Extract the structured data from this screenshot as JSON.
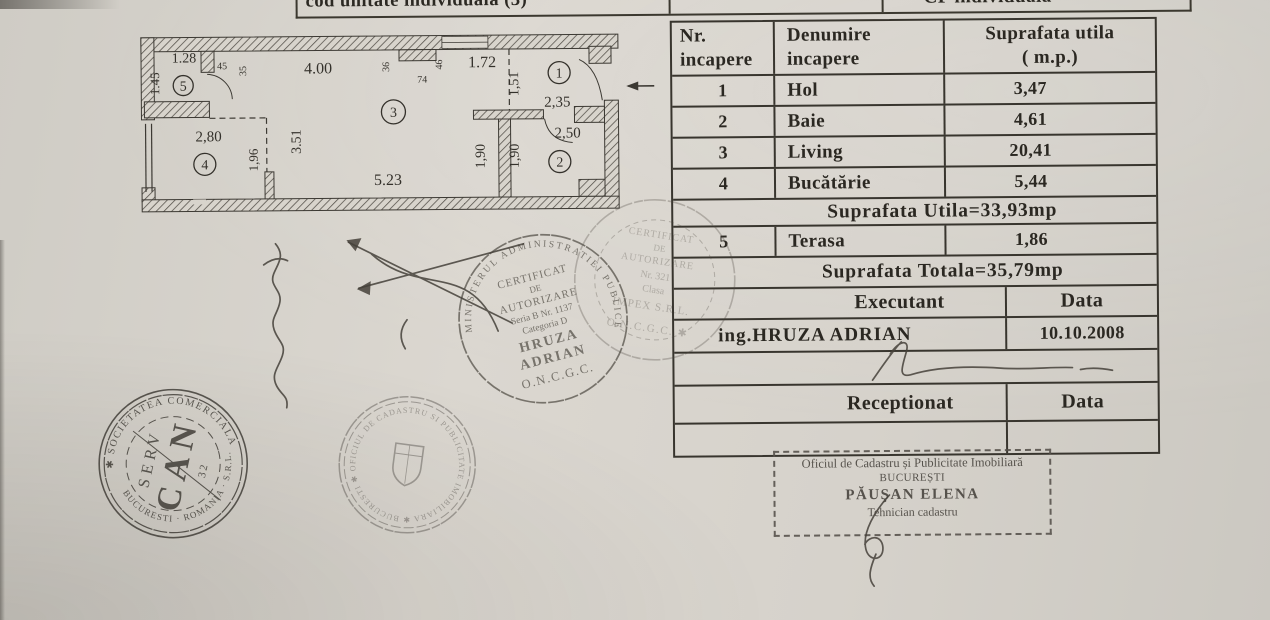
{
  "header_strip": {
    "cell1": "cod unitate individuala (3)",
    "cell2": "",
    "cell3": "CF individuala"
  },
  "room_table": {
    "header": {
      "c1a": "Nr.",
      "c1b": "incapere",
      "c2a": "Denumire",
      "c2b": "incapere",
      "c3a": "Suprafata utila",
      "c3b": "( m.p.)"
    },
    "rows": [
      {
        "nr": "1",
        "name": "Hol",
        "area": "3,47"
      },
      {
        "nr": "2",
        "name": "Baie",
        "area": "4,61"
      },
      {
        "nr": "3",
        "name": "Living",
        "area": "20,41"
      },
      {
        "nr": "4",
        "name": "Bucătărie",
        "area": "5,44"
      }
    ],
    "subtotal": "Suprafata Utila=33,93mp",
    "row5": {
      "nr": "5",
      "name": "Terasa",
      "area": "1,86"
    },
    "total": "Suprafata Totala=35,79mp",
    "executant": {
      "label": "Executant",
      "date_label": "Data",
      "name": "ing.HRUZA ADRIAN",
      "date": "10.10.2008"
    },
    "receptionat": {
      "label": "Receptionat",
      "date_label": "Data"
    }
  },
  "plan": {
    "dims": [
      {
        "text": "1.28",
        "x": 58,
        "y": 33,
        "fs": 14
      },
      {
        "text": "1.45",
        "x": 33,
        "y": 54,
        "rot": -90,
        "fs": 13
      },
      {
        "text": "45",
        "x": 96,
        "y": 40,
        "fs": 10
      },
      {
        "text": "35",
        "x": 120,
        "y": 42,
        "rot": -90,
        "fs": 10
      },
      {
        "text": "4.00",
        "x": 192,
        "y": 45,
        "fs": 16
      },
      {
        "text": "36",
        "x": 263,
        "y": 39,
        "rot": -90,
        "fs": 10
      },
      {
        "text": "74",
        "x": 296,
        "y": 55,
        "fs": 10
      },
      {
        "text": "46",
        "x": 316,
        "y": 37,
        "rot": -90,
        "fs": 10
      },
      {
        "text": "1.72",
        "x": 356,
        "y": 40,
        "fs": 16
      },
      {
        "text": "1,51",
        "x": 392,
        "y": 57,
        "rot": -90,
        "fs": 14
      },
      {
        "text": "2,35",
        "x": 431,
        "y": 80,
        "fs": 15
      },
      {
        "text": "2,50",
        "x": 441,
        "y": 111,
        "fs": 15
      },
      {
        "text": "1,90",
        "x": 358,
        "y": 129,
        "rot": -90,
        "fs": 14
      },
      {
        "text": "1,90",
        "x": 392,
        "y": 129,
        "rot": -90,
        "fs": 14
      },
      {
        "text": "3.51",
        "x": 174,
        "y": 113,
        "rot": -90,
        "fs": 14
      },
      {
        "text": "2,80",
        "x": 82,
        "y": 112,
        "fs": 15
      },
      {
        "text": "1,96",
        "x": 131,
        "y": 131,
        "rot": -90,
        "fs": 13
      },
      {
        "text": "5.23",
        "x": 261,
        "y": 157,
        "fs": 16
      }
    ],
    "rooms": [
      {
        "n": "5",
        "x": 57,
        "y": 56,
        "r": 10
      },
      {
        "n": "4",
        "x": 78,
        "y": 135,
        "r": 11
      },
      {
        "n": "3",
        "x": 267,
        "y": 84,
        "r": 12
      },
      {
        "n": "1",
        "x": 433,
        "y": 46,
        "r": 11
      },
      {
        "n": "2",
        "x": 433,
        "y": 135,
        "r": 11
      }
    ]
  },
  "stamps": {
    "cert_left": {
      "ring": "MINISTERUL  ADMINISTRATIEI  PUBLICE",
      "lines": [
        "CERTIFICAT",
        "DE",
        "AUTORIZARE",
        "Seria B Nr. 1137",
        "Categoria D",
        "HRUZA",
        "ADRIAN",
        "O.N.C.G.C."
      ]
    },
    "cert_right": {
      "lines": [
        "CERTIFICAT",
        "DE",
        "AUTORIZARE",
        "Nr. 321",
        "Clasa",
        "IMPEX S.R.L.",
        "O.N.C.G.C. ✱"
      ]
    },
    "can_serv": {
      "ring_top": "✱ SOCIETATEA COMERCIALA ✱",
      "ring_bottom": "BUCURESTI · ROMANIA · S.R.L.",
      "line1": "CAN",
      "line2": "SERV",
      "number": "32"
    },
    "ocpi_round": {
      "ring": "OFICIUL DE CADASTRU SI PUBLICITATE IMOBILIARA ✱ BUCURESTI ✱"
    },
    "ocpi_box": {
      "line1": "Oficiul de Cadastru și Publicitate Imobiliară",
      "line2": "BUCUREȘTI",
      "line3": "PĂUŞAN ELENA",
      "line4": "Tehnician cadastru"
    }
  }
}
